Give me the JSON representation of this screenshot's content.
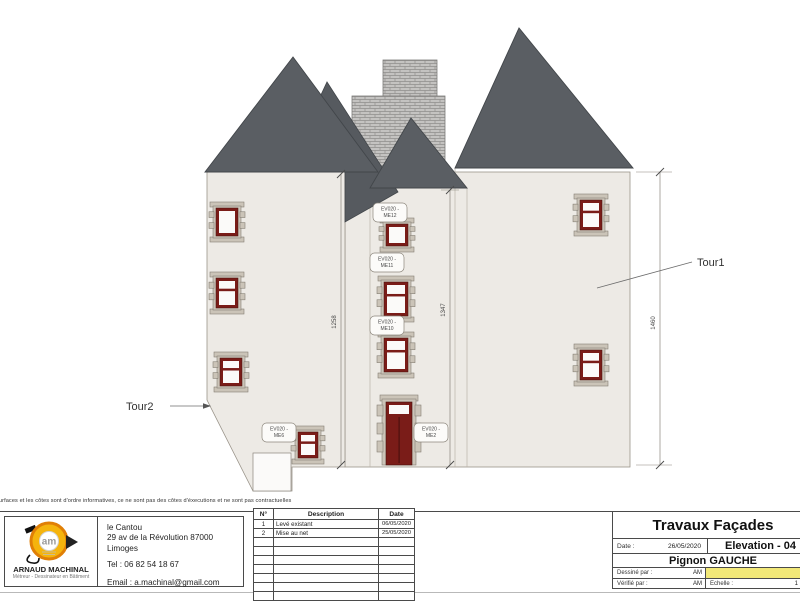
{
  "disclaimer": "surfaces et les côtes sont d'ordre informatives, ce ne sont pas des côtes d'éxecutions et ne sont pas contractuelles",
  "drawing": {
    "tour1": "Tour1",
    "tour2": "Tour2",
    "dim_left_tower": "1258",
    "dim_center": "1347",
    "dim_right_tower": "1460",
    "window_tags": [
      {
        "line1": "EV020 -",
        "line2": "ME12"
      },
      {
        "line1": "EV020 -",
        "line2": "ME11"
      },
      {
        "line1": "EV020 -",
        "line2": "ME10"
      },
      {
        "line1": "EV020 -",
        "line2": "ME6"
      },
      {
        "line1": "EV020 -",
        "line2": "ME2"
      }
    ]
  },
  "company": {
    "logo_monogram": "am",
    "name": "ARNAUD MACHINAL",
    "tagline": "Métreur - Dessinateur en Bâtiment",
    "address_line1": "le Cantou",
    "address_line2": "29 av de la Révolution 87000 Limoges",
    "phone": "Tel : 06 82 54 18 67",
    "email": "Email : a.machinal@gmail.com"
  },
  "revisions": {
    "headers": [
      "N°",
      "Description",
      "Date"
    ],
    "rows": [
      {
        "num": "1",
        "description": "Levé existant",
        "date": "06/05/2020"
      },
      {
        "num": "2",
        "description": "Mise au net",
        "date": "25/05/2020"
      }
    ]
  },
  "title_block": {
    "project_title": "Travaux Façades",
    "date_label": "Date :",
    "date_value": "26/05/2020",
    "sheet_ref": "Elevation - 04",
    "sheet_name": "Pignon GAUCHE",
    "drawn_by_label": "Dessiné par :",
    "drawn_by_value": "AM",
    "checked_by_label": "Vérifié par :",
    "checked_by_value": "AM",
    "scale_label": "Echelle :",
    "scale_value": "1 : 100"
  },
  "colors": {
    "roof": "#5a5e63",
    "wall": "#edeae5",
    "stone": "#cbc4b8",
    "window_frame": "#7a1c18",
    "highlight_yellow": "#f2e878",
    "logo_yellow": "#f5b40d",
    "logo_orange": "#e07f06"
  }
}
